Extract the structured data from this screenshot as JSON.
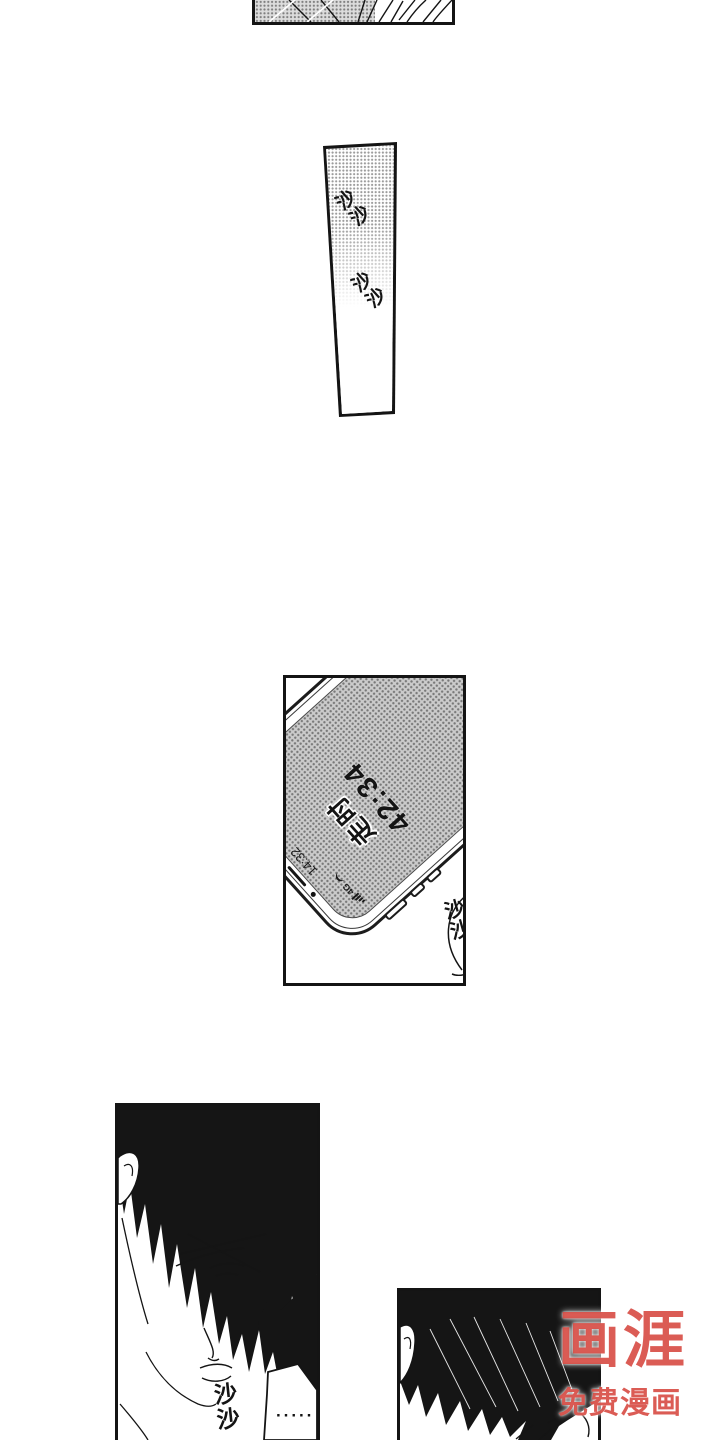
{
  "page": {
    "background": "#ffffff",
    "ink": "#141414"
  },
  "sfx": {
    "rustle_top_1": "沙沙",
    "rustle_top_2": "沙沙",
    "rustle_phone": "沙沙",
    "rustle_face": "沙沙"
  },
  "phone": {
    "timer_label": "走时",
    "timer_value": "42:34",
    "status_time": "14:32",
    "network_label": "4G"
  },
  "speech": {
    "ellipsis": "·····"
  },
  "watermark": {
    "logo": "画涯",
    "tagline": "免费漫画",
    "color": "#d6463d"
  }
}
